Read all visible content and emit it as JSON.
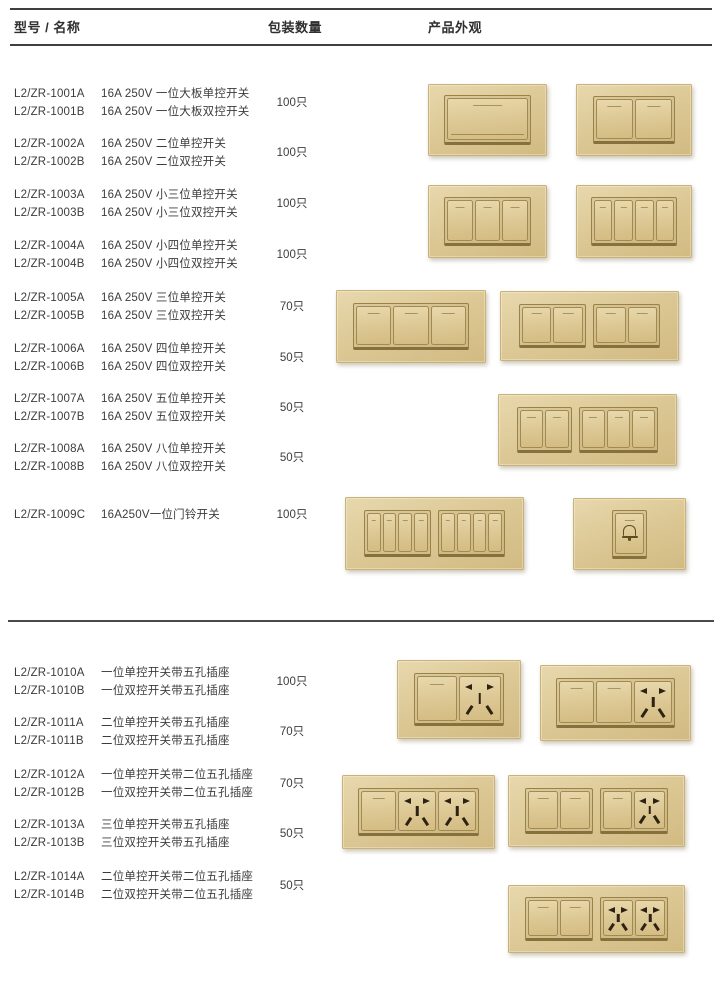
{
  "header": {
    "col_model": "型号 / 名称",
    "col_qty": "包装数量",
    "col_appearance": "产品外观"
  },
  "colors": {
    "plate_gold": "#dcc895",
    "plate_edge": "#c8b277",
    "frame_line": "#9a8147",
    "slot_dark": "#2e2212",
    "text": "#3c3c3c",
    "rule": "#3f3f3f"
  },
  "sections": [
    {
      "name": "switches",
      "rows": [
        {
          "top": 85,
          "models": [
            "L2/ZR-1001A",
            "L2/ZR-1001B"
          ],
          "descs": [
            "16A 250V 一位大板单控开关",
            "16A 250V 一位大板双控开关"
          ],
          "qty": "100只"
        },
        {
          "top": 135,
          "models": [
            "L2/ZR-1002A",
            "L2/ZR-1002B"
          ],
          "descs": [
            "16A 250V 二位单控开关",
            "16A 250V 二位双控开关"
          ],
          "qty": "100只"
        },
        {
          "top": 186,
          "models": [
            "L2/ZR-1003A",
            "L2/ZR-1003B"
          ],
          "descs": [
            "16A 250V 小三位单控开关",
            "16A 250V 小三位双控开关"
          ],
          "qty": "100只"
        },
        {
          "top": 237,
          "models": [
            "L2/ZR-1004A",
            "L2/ZR-1004B"
          ],
          "descs": [
            "16A 250V 小四位单控开关",
            "16A 250V 小四位双控开关"
          ],
          "qty": "100只"
        },
        {
          "top": 289,
          "models": [
            "L2/ZR-1005A",
            "L2/ZR-1005B"
          ],
          "descs": [
            "16A 250V 三位单控开关",
            "16A 250V 三位双控开关"
          ],
          "qty": "70只"
        },
        {
          "top": 340,
          "models": [
            "L2/ZR-1006A",
            "L2/ZR-1006B"
          ],
          "descs": [
            "16A 250V 四位单控开关",
            "16A 250V 四位双控开关"
          ],
          "qty": "50只"
        },
        {
          "top": 390,
          "models": [
            "L2/ZR-1007A",
            "L2/ZR-1007B"
          ],
          "descs": [
            "16A 250V 五位单控开关",
            "16A 250V 五位双控开关"
          ],
          "qty": "50只"
        },
        {
          "top": 440,
          "models": [
            "L2/ZR-1008A",
            "L2/ZR-1008B"
          ],
          "descs": [
            "16A 250V 八位单控开关",
            "16A 250V 八位双控开关"
          ],
          "qty": "50只"
        },
        {
          "top": 506,
          "models": [
            "L2/ZR-1009C"
          ],
          "descs": [
            "16A250V一位门铃开关"
          ],
          "qty": "100只"
        }
      ]
    },
    {
      "name": "switch-socket-combos",
      "rows": [
        {
          "top": 664,
          "models": [
            "L2/ZR-1010A",
            "L2/ZR-1010B"
          ],
          "descs": [
            "一位单控开关带五孔插座",
            "一位双控开关带五孔插座"
          ],
          "qty": "100只"
        },
        {
          "top": 714,
          "models": [
            "L2/ZR-1011A",
            "L2/ZR-1011B"
          ],
          "descs": [
            "二位单控开关带五孔插座",
            "二位双控开关带五孔插座"
          ],
          "qty": "70只"
        },
        {
          "top": 766,
          "models": [
            "L2/ZR-1012A",
            "L2/ZR-1012B"
          ],
          "descs": [
            "一位单控开关带二位五孔插座",
            "一位双控开关带二位五孔插座"
          ],
          "qty": "70只"
        },
        {
          "top": 816,
          "models": [
            "L2/ZR-1013A",
            "L2/ZR-1013B"
          ],
          "descs": [
            "三位单控开关带五孔插座",
            "三位双控开关带五孔插座"
          ],
          "qty": "50只"
        },
        {
          "top": 868,
          "models": [
            "L2/ZR-1014A",
            "L2/ZR-1014B"
          ],
          "descs": [
            "二位单控开关带二位五孔插座",
            "二位双控开关带二位五孔插座"
          ],
          "qty": "50只"
        }
      ]
    }
  ],
  "products": [
    {
      "id": "1001",
      "left": 428,
      "top": 84,
      "width": 117,
      "height": 70,
      "inset": "14% 13%",
      "groups": [
        [
          "rocker-large"
        ]
      ]
    },
    {
      "id": "1002",
      "left": 576,
      "top": 84,
      "width": 114,
      "height": 70,
      "inset": "16% 14%",
      "groups": [
        [
          "rocker",
          "rocker"
        ]
      ]
    },
    {
      "id": "1003",
      "left": 428,
      "top": 185,
      "width": 117,
      "height": 71,
      "inset": "16% 13%",
      "groups": [
        [
          "rocker",
          "rocker",
          "rocker"
        ]
      ]
    },
    {
      "id": "1004",
      "left": 576,
      "top": 185,
      "width": 114,
      "height": 71,
      "inset": "16% 12%",
      "groups": [
        [
          "rocker",
          "rocker",
          "rocker",
          "rocker"
        ]
      ]
    },
    {
      "id": "1005",
      "left": 336,
      "top": 290,
      "width": 148,
      "height": 71,
      "inset": "17% 11%",
      "groups": [
        [
          "rocker",
          "rocker",
          "rocker"
        ]
      ]
    },
    {
      "id": "1006",
      "left": 500,
      "top": 291,
      "width": 177,
      "height": 68,
      "inset": "17% 10%",
      "groups": [
        [
          "rocker",
          "rocker"
        ],
        [
          "rocker",
          "rocker"
        ]
      ]
    },
    {
      "id": "1007",
      "left": 498,
      "top": 394,
      "width": 177,
      "height": 70,
      "inset": "17% 10%",
      "groups": [
        [
          "rocker",
          "rocker"
        ],
        [
          "rocker",
          "rocker",
          "rocker"
        ]
      ]
    },
    {
      "id": "1008",
      "left": 345,
      "top": 497,
      "width": 177,
      "height": 71,
      "inset": "17% 10%",
      "groups": [
        [
          "rocker",
          "rocker",
          "rocker",
          "rocker"
        ],
        [
          "rocker",
          "rocker",
          "rocker",
          "rocker"
        ]
      ]
    },
    {
      "id": "1009",
      "left": 573,
      "top": 498,
      "width": 111,
      "height": 70,
      "inset": "15% 34%",
      "groups": [
        [
          "doorbell"
        ]
      ]
    },
    {
      "id": "1010",
      "left": 397,
      "top": 660,
      "width": 122,
      "height": 77,
      "inset": "16% 13%",
      "groups": [
        [
          "rocker",
          "socket"
        ]
      ]
    },
    {
      "id": "1011",
      "left": 540,
      "top": 665,
      "width": 149,
      "height": 74,
      "inset": "16% 10%",
      "groups": [
        [
          "rocker",
          "rocker",
          "socket"
        ]
      ]
    },
    {
      "id": "1012",
      "left": 342,
      "top": 775,
      "width": 151,
      "height": 72,
      "inset": "16% 10%",
      "groups": [
        [
          "rocker",
          "socket",
          "socket"
        ]
      ]
    },
    {
      "id": "1013",
      "left": 508,
      "top": 775,
      "width": 175,
      "height": 70,
      "inset": "17% 9%",
      "groups": [
        [
          "rocker",
          "rocker"
        ],
        [
          "rocker",
          "socket"
        ]
      ]
    },
    {
      "id": "1014",
      "left": 508,
      "top": 885,
      "width": 175,
      "height": 66,
      "inset": "17% 9%",
      "groups": [
        [
          "rocker",
          "rocker"
        ],
        [
          "socket",
          "socket"
        ]
      ]
    }
  ]
}
